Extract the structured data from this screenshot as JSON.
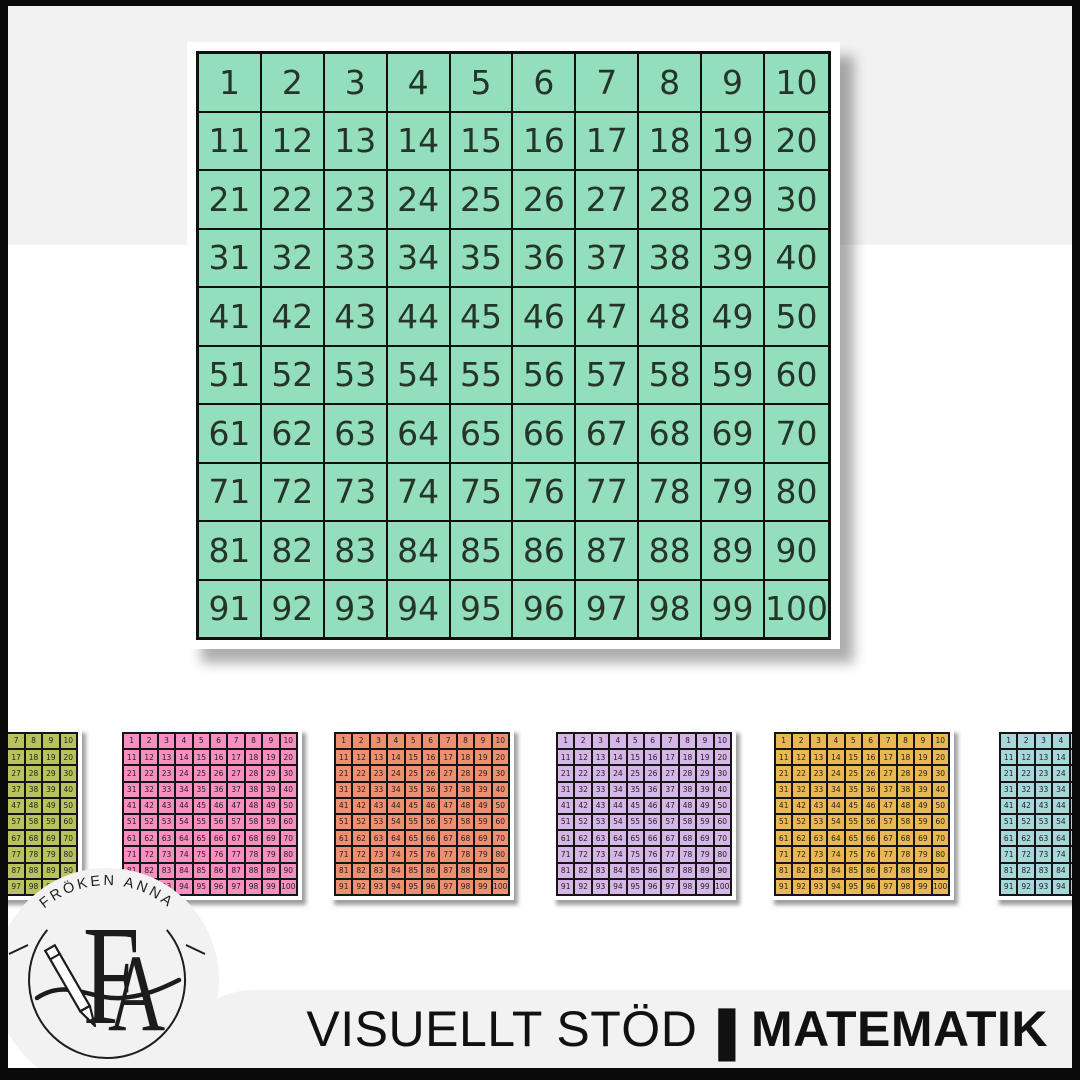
{
  "page": {
    "background": "#ffffff",
    "frame_color": "#0a0a0a",
    "band_color": "#f2f2f2"
  },
  "numbers": [
    1,
    2,
    3,
    4,
    5,
    6,
    7,
    8,
    9,
    10,
    11,
    12,
    13,
    14,
    15,
    16,
    17,
    18,
    19,
    20,
    21,
    22,
    23,
    24,
    25,
    26,
    27,
    28,
    29,
    30,
    31,
    32,
    33,
    34,
    35,
    36,
    37,
    38,
    39,
    40,
    41,
    42,
    43,
    44,
    45,
    46,
    47,
    48,
    49,
    50,
    51,
    52,
    53,
    54,
    55,
    56,
    57,
    58,
    59,
    60,
    61,
    62,
    63,
    64,
    65,
    66,
    67,
    68,
    69,
    70,
    71,
    72,
    73,
    74,
    75,
    76,
    77,
    78,
    79,
    80,
    81,
    82,
    83,
    84,
    85,
    86,
    87,
    88,
    89,
    90,
    91,
    92,
    93,
    94,
    95,
    96,
    97,
    98,
    99,
    100
  ],
  "main_chart": {
    "name": "mint hundred chart",
    "color": "#93dfbb",
    "text_color": "#26352c"
  },
  "small_charts": [
    {
      "name": "olive hundred chart",
      "color": "#b9c35e",
      "text_color": "#222222"
    },
    {
      "name": "pink hundred chart",
      "color": "#f78fc0",
      "text_color": "#222222"
    },
    {
      "name": "coral hundred chart",
      "color": "#ef8f72",
      "text_color": "#222222"
    },
    {
      "name": "lavender hundred chart",
      "color": "#d5b6e6",
      "text_color": "#222222"
    },
    {
      "name": "gold hundred chart",
      "color": "#eab853",
      "text_color": "#222222"
    },
    {
      "name": "teal hundred chart",
      "color": "#a7d6db",
      "text_color": "#222222"
    }
  ],
  "logo": {
    "arc_text": "FRÖKEN ANNA",
    "monogram_f": "F",
    "monogram_a": "A"
  },
  "footer": {
    "title_light": "VISUELLT STÖD",
    "divider": "|",
    "title_bold": "MATEMATIK"
  }
}
